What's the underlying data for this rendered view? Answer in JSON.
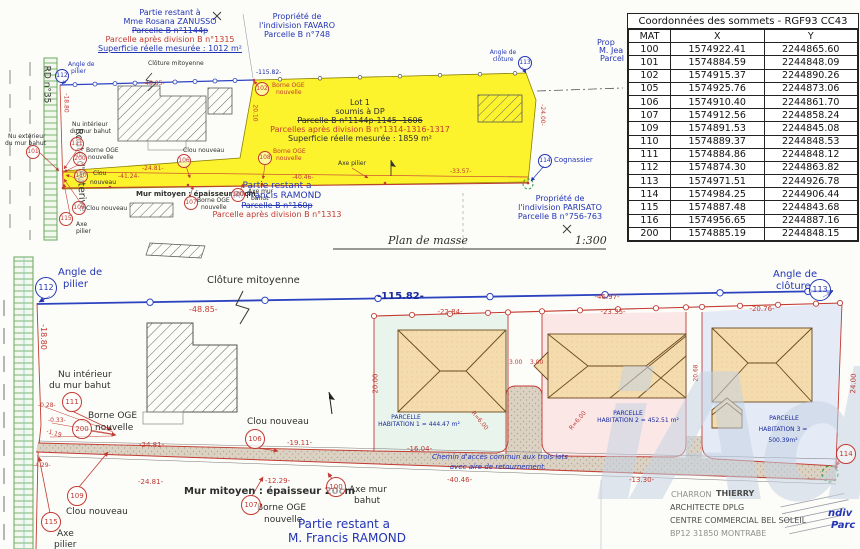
{
  "watermark": {
    "text": "iAd"
  },
  "table": {
    "title": "Coordonnées des sommets - RGF93 CC43",
    "headers": [
      "MAT",
      "X",
      "Y"
    ],
    "rows": [
      [
        "100",
        "1574922.41",
        "2244865.60"
      ],
      [
        "101",
        "1574884.59",
        "2244848.09"
      ],
      [
        "102",
        "1574915.37",
        "2244890.26"
      ],
      [
        "105",
        "1574925.76",
        "2244873.06"
      ],
      [
        "106",
        "1574910.40",
        "2244861.70"
      ],
      [
        "107",
        "1574912.56",
        "2244858.24"
      ],
      [
        "109",
        "1574891.53",
        "2244845.08"
      ],
      [
        "110",
        "1574889.37",
        "2244848.53"
      ],
      [
        "111",
        "1574884.86",
        "2244848.12"
      ],
      [
        "112",
        "1574874.30",
        "2244863.82"
      ],
      [
        "113",
        "1574971.51",
        "2244926.78"
      ],
      [
        "114",
        "1574984.25",
        "2244906.44"
      ],
      [
        "115",
        "1574887.48",
        "2244843.68"
      ],
      [
        "116",
        "1574956.65",
        "2244887.16"
      ],
      [
        "200",
        "1574885.19",
        "2244848.15"
      ]
    ]
  },
  "colors": {
    "black": "#2e2e2e",
    "red": "#c23a32",
    "blue": "#2335b5",
    "navy": "#1a2a9e",
    "gray": "#8f8f8f",
    "dkgray": "#4c4c4c",
    "green": "#2f9e44"
  },
  "top_plan": {
    "labels": [
      {
        "t": "Partie restant à",
        "x": 170,
        "y": 9,
        "c": "blue",
        "s": 8,
        "a": "c"
      },
      {
        "t": "Mme Rosana ZANUSSO",
        "x": 170,
        "y": 18,
        "c": "blue",
        "s": 8,
        "a": "c"
      },
      {
        "t": "Parcelle B n°1144p",
        "x": 170,
        "y": 27,
        "c": "blue",
        "s": 8,
        "a": "c",
        "st": 1
      },
      {
        "t": "Parcelle après division B n°1315",
        "x": 170,
        "y": 36,
        "c": "red",
        "s": 8,
        "a": "c"
      },
      {
        "t": "Superficie réelle mesurée : 1012 m²",
        "x": 170,
        "y": 45,
        "c": "blue",
        "s": 8,
        "a": "c",
        "u": 1
      },
      {
        "t": "Propriété de",
        "x": 297,
        "y": 13,
        "c": "blue",
        "s": 8,
        "a": "c"
      },
      {
        "t": "l'indivision FAVARO",
        "x": 297,
        "y": 22,
        "c": "blue",
        "s": 8,
        "a": "c"
      },
      {
        "t": "Parcelle B n°748",
        "x": 297,
        "y": 31,
        "c": "blue",
        "s": 8,
        "a": "c"
      },
      {
        "t": "Prop",
        "x": 597,
        "y": 39,
        "c": "blue",
        "s": 8
      },
      {
        "t": "M. Jea",
        "x": 599,
        "y": 47,
        "c": "blue",
        "s": 8
      },
      {
        "t": "Parcel",
        "x": 600,
        "y": 55,
        "c": "blue",
        "s": 8
      },
      {
        "t": "Lot 1",
        "x": 360,
        "y": 99,
        "s": 8,
        "a": "c",
        "n": "lot1-title"
      },
      {
        "t": "soumis à DP",
        "x": 360,
        "y": 108,
        "s": 8,
        "a": "c"
      },
      {
        "t": "Parcelle B n°1144p-1145 -1606",
        "x": 360,
        "y": 117,
        "s": 8,
        "a": "c",
        "st": 1
      },
      {
        "t": "Parcelles après division B n°1314-1316-1317",
        "x": 360,
        "y": 126,
        "c": "red",
        "s": 8,
        "a": "c"
      },
      {
        "t": "Superficie réelle mesurée : 1859 m²",
        "x": 360,
        "y": 135,
        "s": 8,
        "a": "c"
      },
      {
        "t": "RD n°35",
        "x": 27,
        "y": 80,
        "s": 9,
        "r": 90
      },
      {
        "t": "Route d'Auterive",
        "x": 38,
        "y": 165,
        "s": 10,
        "r": 87
      },
      {
        "t": "Clôture mitoyenne",
        "x": 148,
        "y": 61,
        "s": 6
      },
      {
        "t": "-115.82-",
        "x": 256,
        "y": 70,
        "c": "navy",
        "s": 6
      },
      {
        "t": "Borne OGE",
        "x": 272,
        "y": 83,
        "c": "red",
        "s": 6
      },
      {
        "t": "nouvelle",
        "x": 276,
        "y": 90,
        "c": "red",
        "s": 6
      },
      {
        "t": "Angle de",
        "x": 68,
        "y": 62,
        "c": "blue",
        "s": 6
      },
      {
        "t": "pilier",
        "x": 71,
        "y": 69,
        "c": "blue",
        "s": 6
      },
      {
        "t": "Angle de",
        "x": 503,
        "y": 50,
        "c": "blue",
        "s": 6,
        "a": "c"
      },
      {
        "t": "clôture",
        "x": 503,
        "y": 57,
        "c": "blue",
        "s": 6,
        "a": "c"
      },
      {
        "t": "Cognassier",
        "x": 554,
        "y": 157,
        "c": "blue",
        "s": 7
      },
      {
        "t": "Propriété de",
        "x": 560,
        "y": 195,
        "c": "blue",
        "s": 8,
        "a": "c"
      },
      {
        "t": "l'indivision PARISATO",
        "x": 560,
        "y": 204,
        "c": "blue",
        "s": 8,
        "a": "c"
      },
      {
        "t": "Parcelle B n°756-763",
        "x": 560,
        "y": 213,
        "c": "blue",
        "s": 8,
        "a": "c"
      },
      {
        "t": "Partie restant a",
        "x": 277,
        "y": 182,
        "c": "blue",
        "s": 9,
        "a": "c"
      },
      {
        "t": "M. Francis RAMOND",
        "x": 277,
        "y": 192,
        "c": "blue",
        "s": 9,
        "a": "c"
      },
      {
        "t": "Parcelle B n°160p",
        "x": 277,
        "y": 202,
        "c": "blue",
        "s": 8,
        "a": "c",
        "st": 1
      },
      {
        "t": "Parcelle après division B n°1313",
        "x": 277,
        "y": 211,
        "c": "red",
        "s": 8,
        "a": "c"
      },
      {
        "t": "Plan de masse",
        "x": 428,
        "y": 235,
        "s": 11,
        "a": "c",
        "f": "hand",
        "n": "plan-title"
      },
      {
        "t": "1:300",
        "x": 575,
        "y": 235,
        "s": 11,
        "f": "hand",
        "n": "scale-label"
      },
      {
        "t": "Nu intérieur",
        "x": 72,
        "y": 122,
        "s": 6
      },
      {
        "t": "du mur bahut",
        "x": 70,
        "y": 129,
        "s": 6
      },
      {
        "t": "Nu extérieur",
        "x": 8,
        "y": 134,
        "s": 6
      },
      {
        "t": "du mur bahut",
        "x": 5,
        "y": 141,
        "s": 6
      },
      {
        "t": "Borne OGE",
        "x": 86,
        "y": 148,
        "s": 6
      },
      {
        "t": "nouvelle",
        "x": 88,
        "y": 155,
        "s": 6
      },
      {
        "t": "Clou",
        "x": 93,
        "y": 171,
        "s": 6
      },
      {
        "t": "nouveau",
        "x": 90,
        "y": 180,
        "s": 6
      },
      {
        "t": "Clou nouveau",
        "x": 86,
        "y": 206,
        "s": 6
      },
      {
        "t": "Axe",
        "x": 76,
        "y": 222,
        "s": 6
      },
      {
        "t": "pilier",
        "x": 76,
        "y": 229,
        "s": 6
      },
      {
        "t": "Clou nouveau",
        "x": 183,
        "y": 148,
        "s": 6
      },
      {
        "t": "Borne OGE",
        "x": 273,
        "y": 149,
        "c": "red",
        "s": 6
      },
      {
        "t": "nouvelle",
        "x": 276,
        "y": 156,
        "c": "red",
        "s": 6
      },
      {
        "t": "Axe pilier",
        "x": 338,
        "y": 161,
        "s": 6
      },
      {
        "t": "Mur mitoyen : épaisseur 20cm",
        "x": 136,
        "y": 191,
        "s": 7,
        "b": 1
      },
      {
        "t": "Borne OGE",
        "x": 197,
        "y": 198,
        "s": 6
      },
      {
        "t": "nouvelle",
        "x": 201,
        "y": 205,
        "s": 6
      },
      {
        "t": "Axe mur",
        "x": 248,
        "y": 189,
        "s": 6
      },
      {
        "t": "bahut",
        "x": 251,
        "y": 196,
        "s": 6
      },
      {
        "t": "-48.85-",
        "x": 143,
        "y": 81,
        "c": "red",
        "s": 6
      },
      {
        "t": "-41.24-",
        "x": 118,
        "y": 174,
        "c": "red",
        "s": 6
      },
      {
        "t": "-24.81-",
        "x": 142,
        "y": 166,
        "c": "red",
        "s": 6
      },
      {
        "t": "-40.46-",
        "x": 292,
        "y": 175,
        "c": "red",
        "s": 6
      },
      {
        "t": "-33.57-",
        "x": 450,
        "y": 169,
        "c": "red",
        "s": 6
      },
      {
        "t": "-24.00-",
        "x": 531,
        "y": 112,
        "c": "red",
        "s": 6,
        "r": 90
      },
      {
        "t": "20.10",
        "x": 246,
        "y": 110,
        "c": "red",
        "s": 6,
        "r": 90
      },
      {
        "t": "-18.80",
        "x": 56,
        "y": 100,
        "c": "red",
        "s": 6,
        "r": 90
      }
    ],
    "badges": [
      {
        "n": "112",
        "x": 62,
        "y": 76,
        "c": "blue",
        "r": 6
      },
      {
        "n": "113",
        "x": 525,
        "y": 63,
        "c": "blue",
        "r": 6
      },
      {
        "n": "114",
        "x": 545,
        "y": 161,
        "c": "blue",
        "r": 6
      },
      {
        "n": "102",
        "x": 262,
        "y": 89,
        "c": "red",
        "r": 6
      },
      {
        "n": "101",
        "x": 33,
        "y": 152,
        "c": "red",
        "r": 6
      },
      {
        "n": "111",
        "x": 77,
        "y": 144,
        "c": "red",
        "r": 6
      },
      {
        "n": "200",
        "x": 80,
        "y": 159,
        "c": "red",
        "r": 6
      },
      {
        "n": "110",
        "x": 81,
        "y": 176,
        "c": "red",
        "r": 6
      },
      {
        "n": "109",
        "x": 79,
        "y": 208,
        "c": "red",
        "r": 6
      },
      {
        "n": "115",
        "x": 66,
        "y": 219,
        "c": "red",
        "r": 6
      },
      {
        "n": "106",
        "x": 184,
        "y": 161,
        "c": "red",
        "r": 6
      },
      {
        "n": "108",
        "x": 265,
        "y": 158,
        "c": "red",
        "r": 6
      },
      {
        "n": "107",
        "x": 191,
        "y": 203,
        "c": "red",
        "r": 6
      },
      {
        "n": "100",
        "x": 238,
        "y": 195,
        "c": "red",
        "r": 6
      }
    ]
  },
  "bottom_plan": {
    "labels": [
      {
        "t": "Angle de",
        "x": 58,
        "y": 268,
        "c": "blue",
        "s": 10
      },
      {
        "t": "pilier",
        "x": 63,
        "y": 280,
        "c": "blue",
        "s": 10
      },
      {
        "t": "Clôture mitoyenne",
        "x": 207,
        "y": 276,
        "s": 10
      },
      {
        "t": "-48.85-",
        "x": 189,
        "y": 306,
        "c": "red",
        "s": 8
      },
      {
        "t": "-115.82-",
        "x": 377,
        "y": 292,
        "c": "navy",
        "s": 10,
        "b": 1
      },
      {
        "t": "-18.80",
        "x": 30,
        "y": 333,
        "c": "red",
        "s": 8,
        "r": 90
      },
      {
        "t": "Angle de",
        "x": 773,
        "y": 270,
        "c": "blue",
        "s": 10
      },
      {
        "t": "clôture",
        "x": 776,
        "y": 282,
        "c": "blue",
        "s": 10
      },
      {
        "t": "Nu intérieur",
        "x": 58,
        "y": 371,
        "s": 9
      },
      {
        "t": "du mur bahut",
        "x": 49,
        "y": 382,
        "s": 9
      },
      {
        "t": "Borne OGE",
        "x": 88,
        "y": 412,
        "s": 9
      },
      {
        "t": "nouvelle",
        "x": 95,
        "y": 424,
        "s": 9
      },
      {
        "t": "Clou nouveau",
        "x": 247,
        "y": 418,
        "s": 9
      },
      {
        "t": "Clou nouveau",
        "x": 66,
        "y": 508,
        "s": 9
      },
      {
        "t": "Axe",
        "x": 57,
        "y": 530,
        "s": 9
      },
      {
        "t": "pilier",
        "x": 54,
        "y": 541,
        "s": 9
      },
      {
        "t": "Mur mitoyen : épaisseur 20cm",
        "x": 184,
        "y": 487,
        "s": 10,
        "b": 1
      },
      {
        "t": "Borne OGE",
        "x": 257,
        "y": 504,
        "s": 9
      },
      {
        "t": "nouvelle",
        "x": 264,
        "y": 516,
        "s": 9
      },
      {
        "t": "Axe mur",
        "x": 349,
        "y": 486,
        "s": 9
      },
      {
        "t": "bahut",
        "x": 354,
        "y": 497,
        "s": 9
      },
      {
        "t": "Partie restant a",
        "x": 344,
        "y": 518,
        "c": "blue",
        "s": 12,
        "a": "c"
      },
      {
        "t": "M. Francis RAMOND",
        "x": 347,
        "y": 532,
        "c": "blue",
        "s": 12,
        "a": "c"
      },
      {
        "t": "PARCELLE",
        "x": 406,
        "y": 415,
        "c": "navy",
        "s": 6,
        "a": "c"
      },
      {
        "t": "HABITATION 1 = 444.47 m²",
        "x": 419,
        "y": 422,
        "c": "navy",
        "s": 6,
        "a": "c"
      },
      {
        "t": "PARCELLE",
        "x": 628,
        "y": 411,
        "c": "navy",
        "s": 6,
        "a": "c"
      },
      {
        "t": "HABITATION 2 = 452.51 m²",
        "x": 638,
        "y": 418,
        "c": "navy",
        "s": 6,
        "a": "c"
      },
      {
        "t": "PARCELLE",
        "x": 784,
        "y": 416,
        "c": "navy",
        "s": 6,
        "a": "c"
      },
      {
        "t": "HABITATION 3 =",
        "x": 783,
        "y": 427,
        "c": "navy",
        "s": 6,
        "a": "c"
      },
      {
        "t": "500.39m²",
        "x": 783,
        "y": 438,
        "c": "navy",
        "s": 6,
        "a": "c"
      },
      {
        "t": "Chemin d'accès commun aux trois lots",
        "x": 500,
        "y": 454,
        "c": "blue",
        "s": 7,
        "a": "c",
        "i": 1
      },
      {
        "t": "avec aire de retournement.",
        "x": 498,
        "y": 464,
        "c": "blue",
        "s": 7,
        "a": "c",
        "i": 1
      },
      {
        "t": "-22.84-",
        "x": 450,
        "y": 309,
        "c": "red",
        "s": 7,
        "a": "c"
      },
      {
        "t": "-23.35-",
        "x": 613,
        "y": 309,
        "c": "red",
        "s": 7,
        "a": "c"
      },
      {
        "t": "-20.76-",
        "x": 762,
        "y": 306,
        "c": "red",
        "s": 7,
        "a": "c"
      },
      {
        "t": "-46.97-",
        "x": 607,
        "y": 294,
        "c": "red",
        "s": 7,
        "a": "c"
      },
      {
        "t": "20.00",
        "x": 366,
        "y": 380,
        "c": "red",
        "s": 7,
        "r": -90
      },
      {
        "t": "3.00",
        "x": 509,
        "y": 360,
        "c": "red",
        "s": 6
      },
      {
        "t": "3.00",
        "x": 530,
        "y": 360,
        "c": "red",
        "s": 6
      },
      {
        "t": "R=6.00",
        "x": 468,
        "y": 418,
        "c": "red",
        "s": 6,
        "r": 50
      },
      {
        "t": "R=6.00",
        "x": 567,
        "y": 418,
        "c": "red",
        "s": 6,
        "r": -50
      },
      {
        "t": "-24.81-",
        "x": 139,
        "y": 442,
        "c": "red",
        "s": 7
      },
      {
        "t": "-24.81-",
        "x": 138,
        "y": 479,
        "c": "red",
        "s": 7
      },
      {
        "t": "-19.11-",
        "x": 287,
        "y": 440,
        "c": "red",
        "s": 7
      },
      {
        "t": "-12.29-",
        "x": 265,
        "y": 478,
        "c": "red",
        "s": 7
      },
      {
        "t": "-16.04-",
        "x": 407,
        "y": 446,
        "c": "red",
        "s": 7
      },
      {
        "t": "-40.46-",
        "x": 447,
        "y": 477,
        "c": "red",
        "s": 7
      },
      {
        "t": "-13.30-",
        "x": 629,
        "y": 477,
        "c": "red",
        "s": 7
      },
      {
        "t": "-0.28-",
        "x": 38,
        "y": 403,
        "c": "red",
        "s": 6
      },
      {
        "t": "-0.33-",
        "x": 48,
        "y": 418,
        "c": "red",
        "s": 6
      },
      {
        "t": "-1.19",
        "x": 46,
        "y": 431,
        "c": "red",
        "s": 6,
        "r": 15
      },
      {
        "t": "-4.29-",
        "x": 33,
        "y": 463,
        "c": "red",
        "s": 6
      },
      {
        "t": "24.00",
        "x": 844,
        "y": 380,
        "c": "red",
        "s": 7,
        "r": -88
      },
      {
        "t": "20.68",
        "x": 688,
        "y": 370,
        "c": "red",
        "s": 6,
        "r": -90
      },
      {
        "t": "CHARRON",
        "x": 671,
        "y": 491,
        "c": "gray",
        "s": 8
      },
      {
        "t": "THIERRY",
        "x": 716,
        "y": 490,
        "c": "dkgray",
        "s": 8,
        "b": 1
      },
      {
        "t": "ARCHITECTE DPLG",
        "x": 670,
        "y": 504,
        "c": "dkgray",
        "s": 8
      },
      {
        "t": "CENTRE COMMERCIAL BEL SOLEIL",
        "x": 670,
        "y": 517,
        "c": "dkgray",
        "s": 8
      },
      {
        "t": "BP12 31850 MONTRABE",
        "x": 670,
        "y": 530,
        "c": "gray",
        "s": 8
      },
      {
        "t": "ndiv",
        "x": 828,
        "y": 509,
        "c": "blue",
        "s": 10,
        "b": 1,
        "i": 1
      },
      {
        "t": "Parc",
        "x": 831,
        "y": 521,
        "c": "blue",
        "s": 10,
        "b": 1,
        "i": 1
      }
    ],
    "badges": [
      {
        "n": "112",
        "x": 46,
        "y": 288,
        "c": "blue",
        "r": 10
      },
      {
        "n": "113",
        "x": 820,
        "y": 290,
        "c": "blue",
        "r": 10
      },
      {
        "n": "111",
        "x": 72,
        "y": 402,
        "c": "red",
        "r": 9
      },
      {
        "n": "200",
        "x": 82,
        "y": 429,
        "c": "red",
        "r": 9
      },
      {
        "n": "106",
        "x": 255,
        "y": 439,
        "c": "red",
        "r": 9
      },
      {
        "n": "109",
        "x": 77,
        "y": 496,
        "c": "red",
        "r": 9
      },
      {
        "n": "115",
        "x": 51,
        "y": 522,
        "c": "red",
        "r": 9
      },
      {
        "n": "107",
        "x": 251,
        "y": 505,
        "c": "red",
        "r": 9
      },
      {
        "n": "100",
        "x": 336,
        "y": 487,
        "c": "red",
        "r": 9
      },
      {
        "n": "114",
        "x": 846,
        "y": 454,
        "c": "red",
        "r": 9
      }
    ]
  }
}
